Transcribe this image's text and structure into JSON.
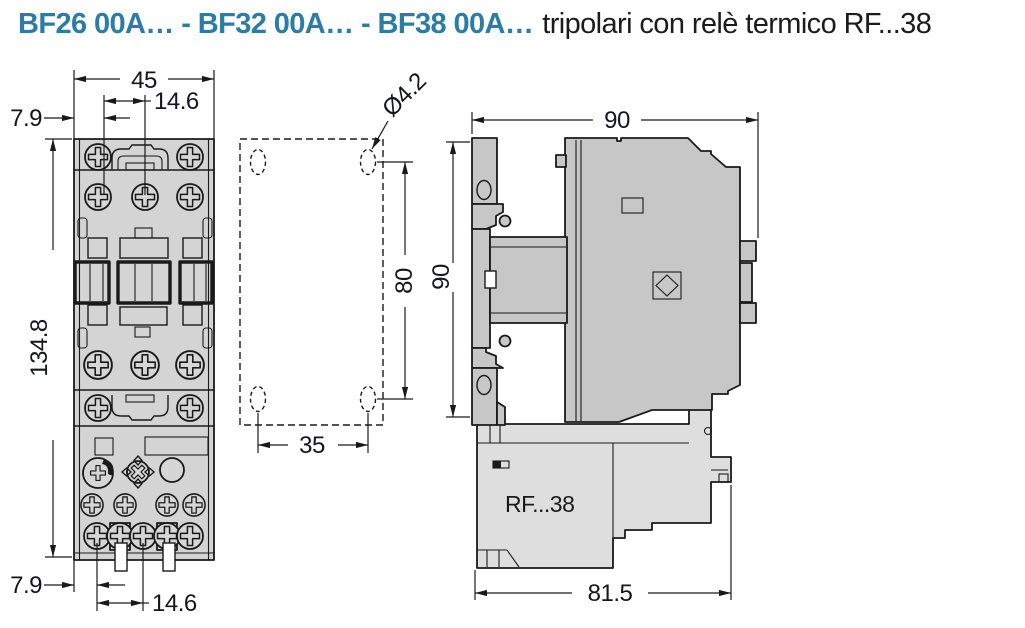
{
  "page": {
    "title_bold": "BF26 00A… - BF32 00A… - BF38 00A…",
    "title_regular": "tripolari con relè termico RF...38"
  },
  "colors": {
    "accent_blue": "#2b7ca7",
    "line_black": "#1a1a1a",
    "front_body_gray": "#d4d4d4",
    "side_body_gray": "#c7c7c7",
    "relay_gray": "#dedede"
  },
  "front_view": {
    "dim_width": "45",
    "dim_pitch_top": "14.6",
    "dim_offset_top": "7.9",
    "dim_height": "134.8",
    "dim_offset_bottom": "7.9",
    "dim_pitch_bottom": "14.6"
  },
  "drilling_plan": {
    "dim_hole_diameter": "Ø4.2",
    "dim_vertical_pitch": "80",
    "dim_horizontal_pitch": "35"
  },
  "side_view": {
    "dim_width": "90",
    "dim_height": "90",
    "dim_depth": "81.5",
    "relay_label": "RF...38"
  }
}
